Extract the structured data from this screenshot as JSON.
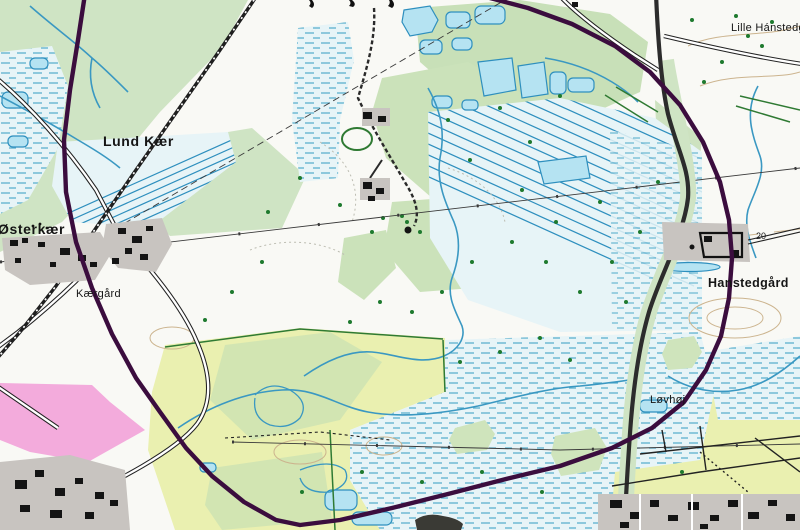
{
  "map": {
    "title": "Topographic map extract with study-area boundary",
    "labels": {
      "lund_kaer": "Lund Kær",
      "oesterkaer": "Østerkær",
      "kaergaard": "Kærgård",
      "hanstedgaard": "Hanstedgård",
      "loevhoej": "Løvhøj",
      "lille_hanstedgaard": "Lille Hánstedgård",
      "contour_20": "20"
    },
    "boundary": {
      "description": "dark purple closed boundary curve (study area)",
      "color": "#3b0d3e"
    },
    "colors": {
      "paper": "#f9f9f5",
      "meadow_green": "#cfe4c4",
      "field_yellow": "#eaf0b0",
      "field_green": "#d2e5b2",
      "wetland_bg": "#e7f4f7",
      "water_line": "#2e8fbe",
      "pond_fill": "#b5e3f2",
      "stream": "#3a98c2",
      "urban_gray": "#c8c4c0",
      "building_black": "#141414",
      "pink_zone": "#f3abdc",
      "road_dark": "#2c2c2c",
      "railway": "#1f1f1f",
      "contour_tan": "#ccb48e",
      "tree_green": "#1e7a2e"
    }
  }
}
